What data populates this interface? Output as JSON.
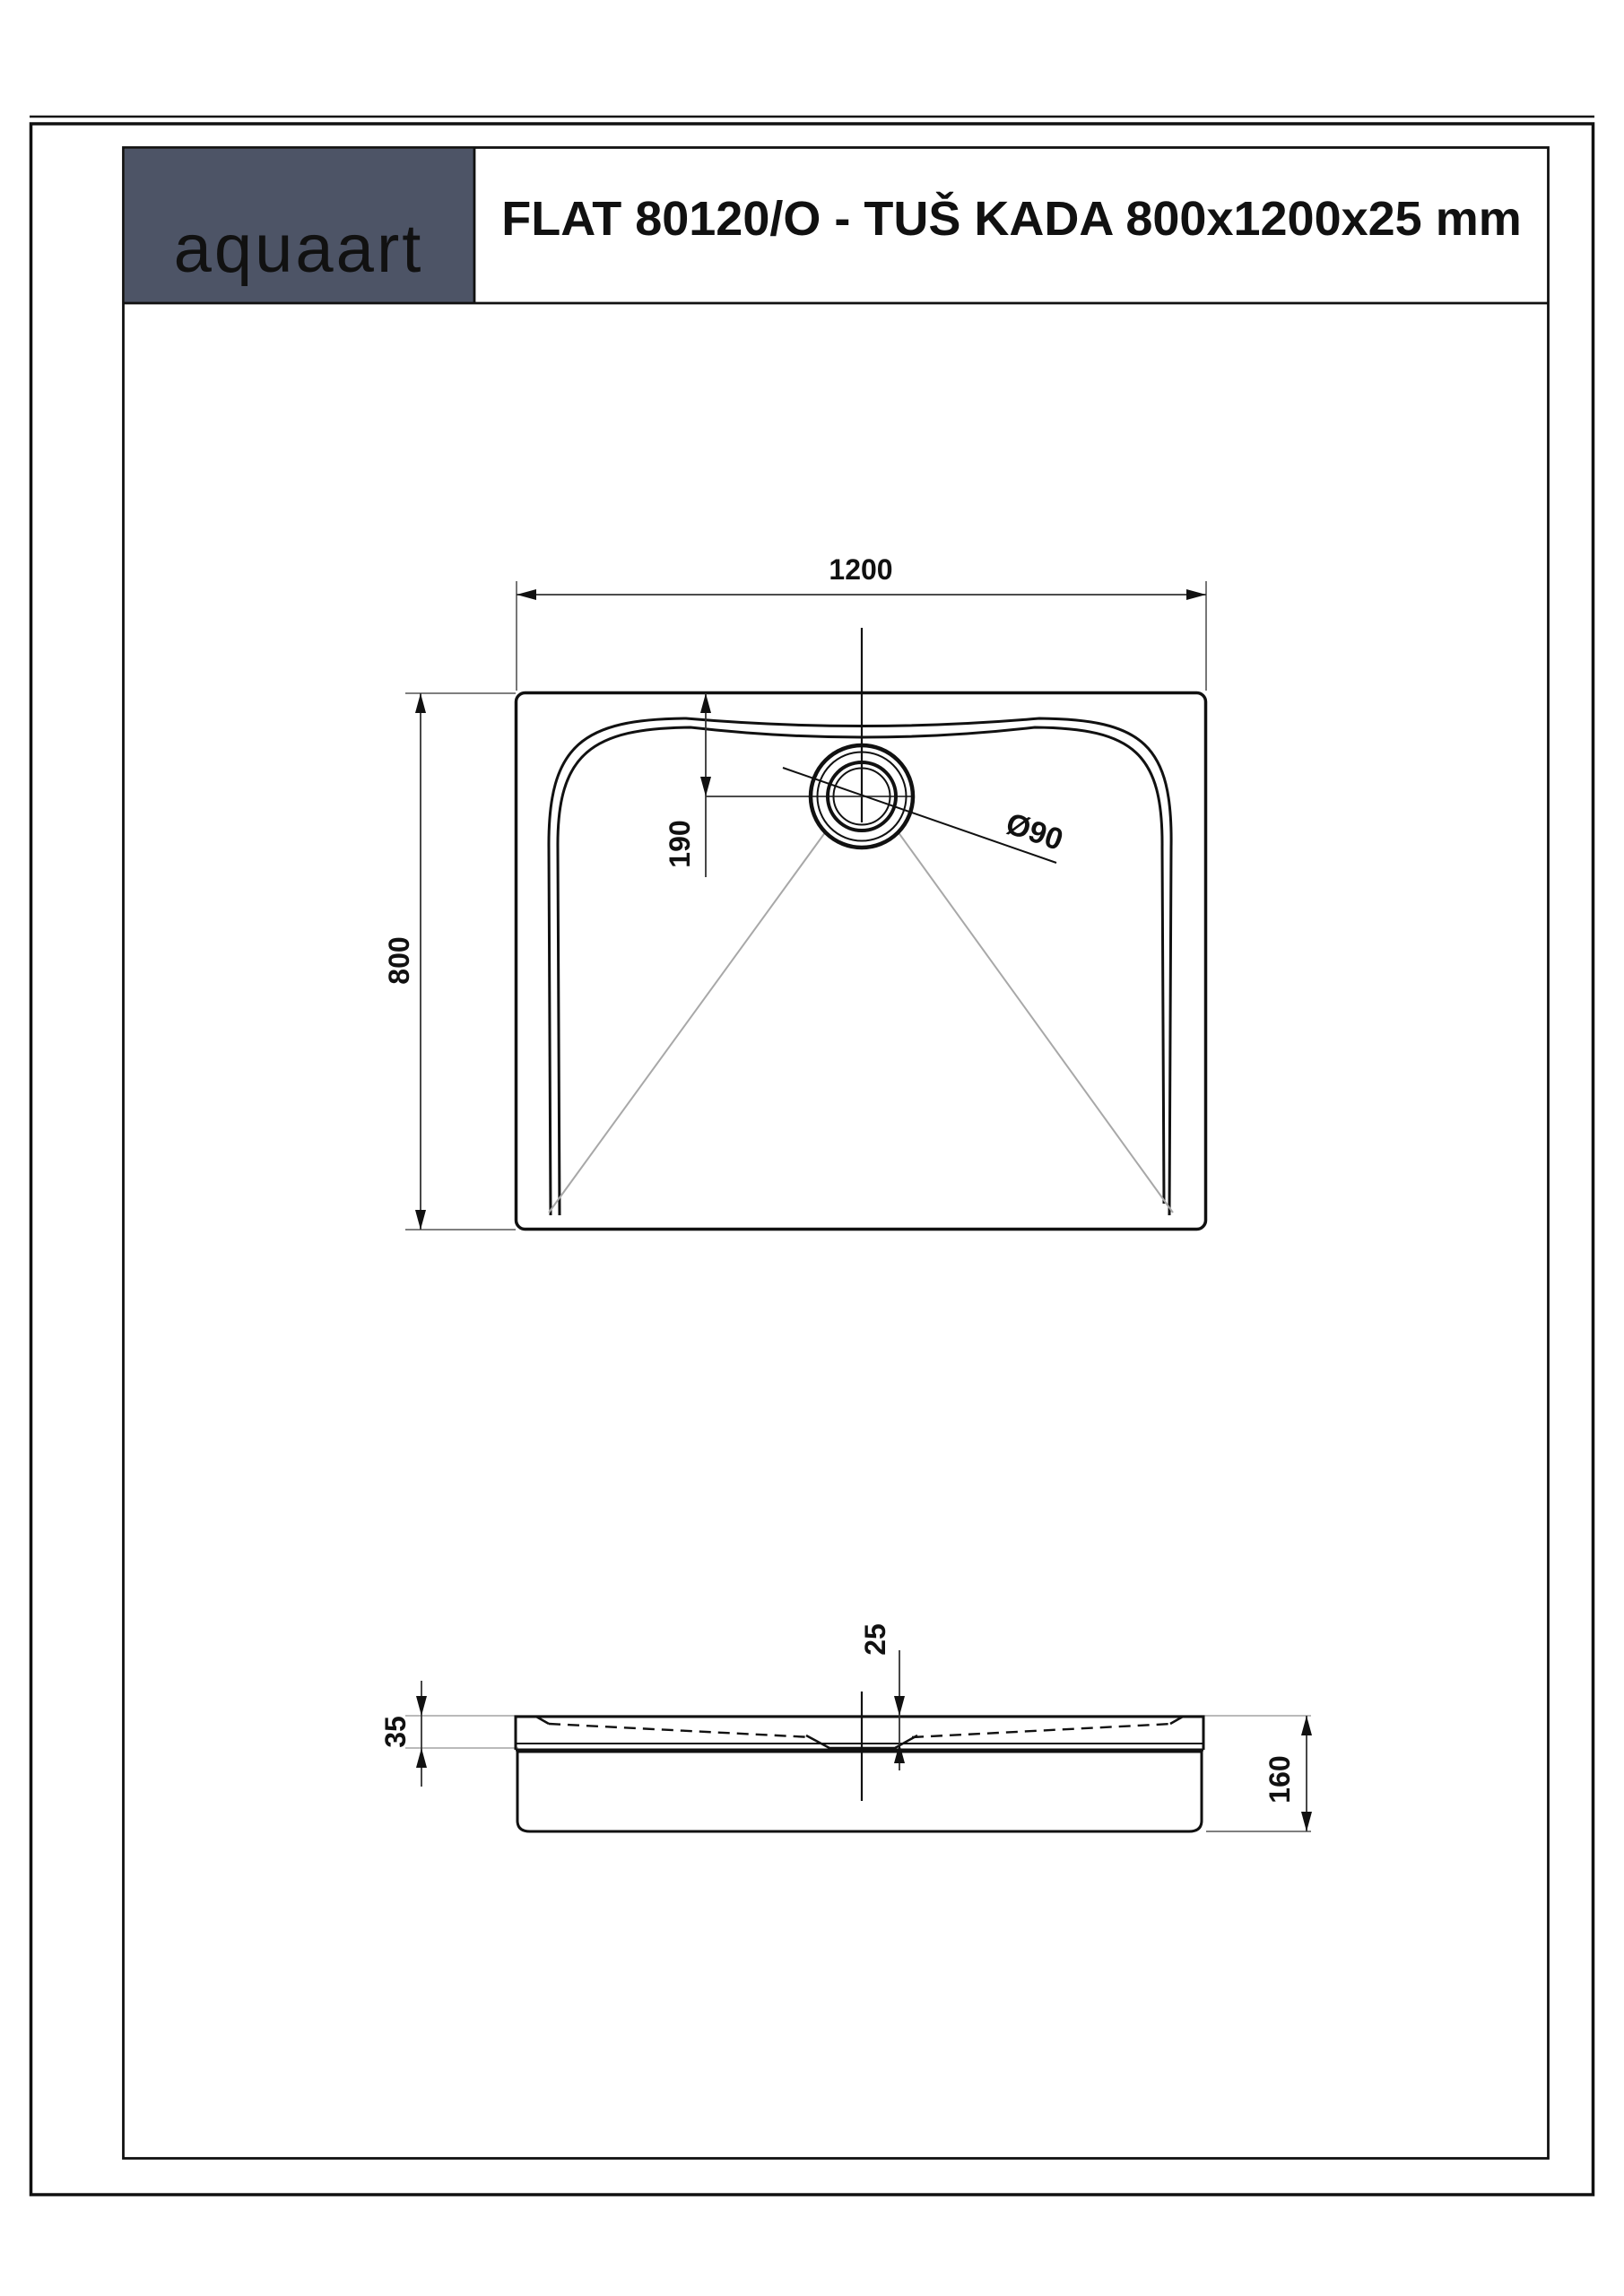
{
  "header": {
    "logo_text": "aquaart",
    "logo_color": "#d4e2d2",
    "box_color": "#4d5466",
    "title": "FLAT 80120/O - TUŠ KADA 800x1200x25 mm"
  },
  "top_view": {
    "width_label": "1200",
    "height_label": "800",
    "drain_offset_label": "190",
    "drain_diameter_label": "Ø90"
  },
  "side_view": {
    "tray_thickness_label": "25",
    "rim_height_label": "35",
    "total_height_label": "160"
  },
  "colors": {
    "drawing_line": "#111111",
    "dim_line": "#333333",
    "reference_line": "#b0b0b0",
    "page_background": "#ffffff"
  }
}
